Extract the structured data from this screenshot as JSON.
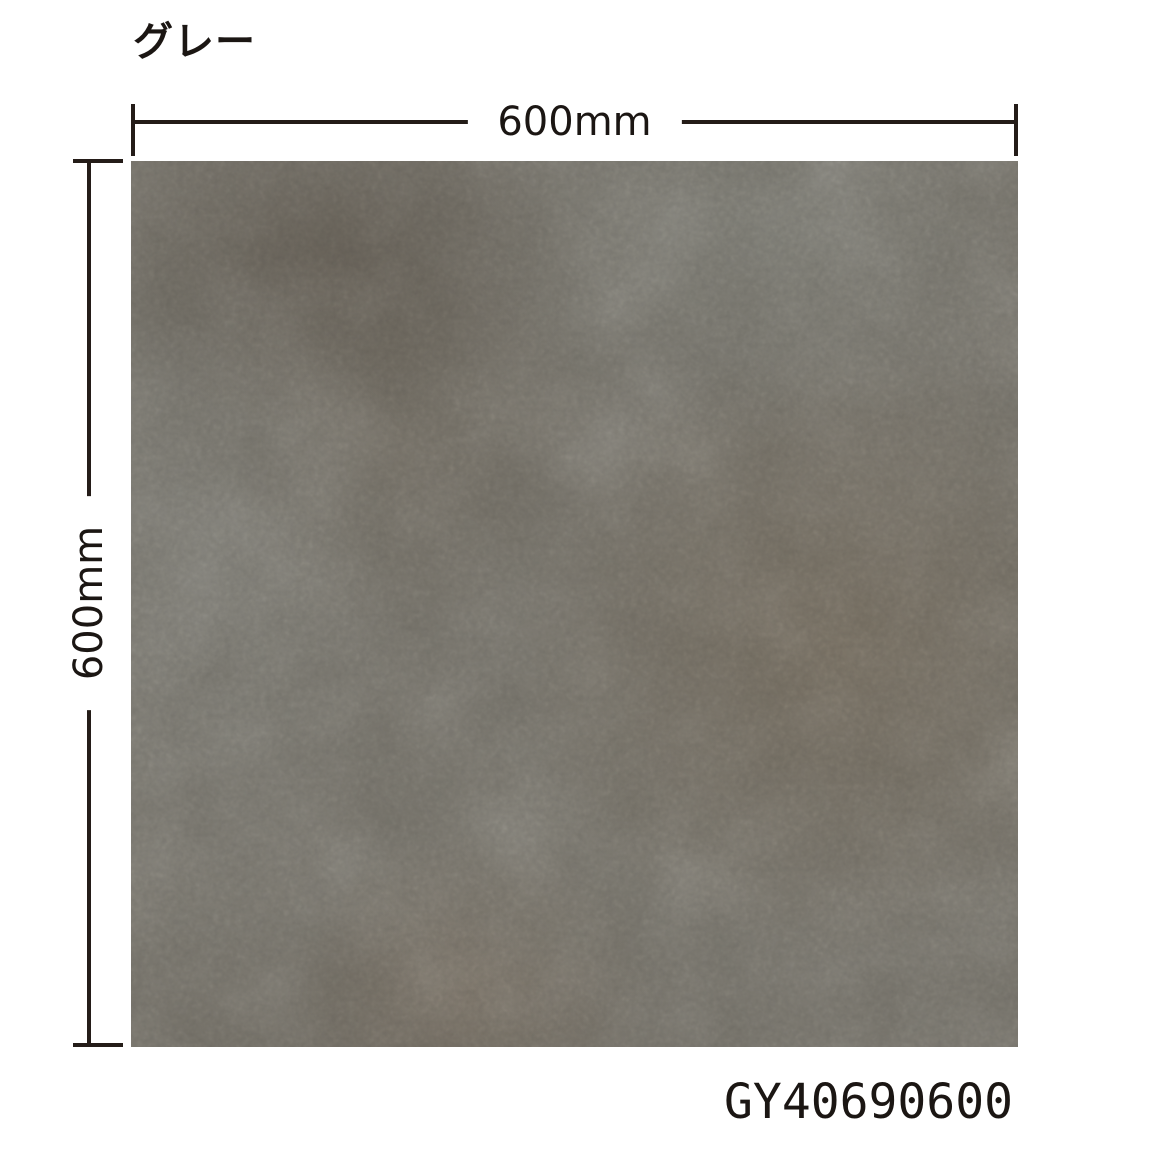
{
  "title": "グレー",
  "dimension_width": {
    "label": "600mm"
  },
  "dimension_height": {
    "label": "600mm"
  },
  "product_code": "GY40690600",
  "colors": {
    "background": "#ffffff",
    "line": "#241c18",
    "text": "#1b1613",
    "tile-base": "#6f6c64",
    "tile-light": "#7a7a73",
    "tile-brown": "#6f6557",
    "tile-dark": "#5a554c"
  }
}
